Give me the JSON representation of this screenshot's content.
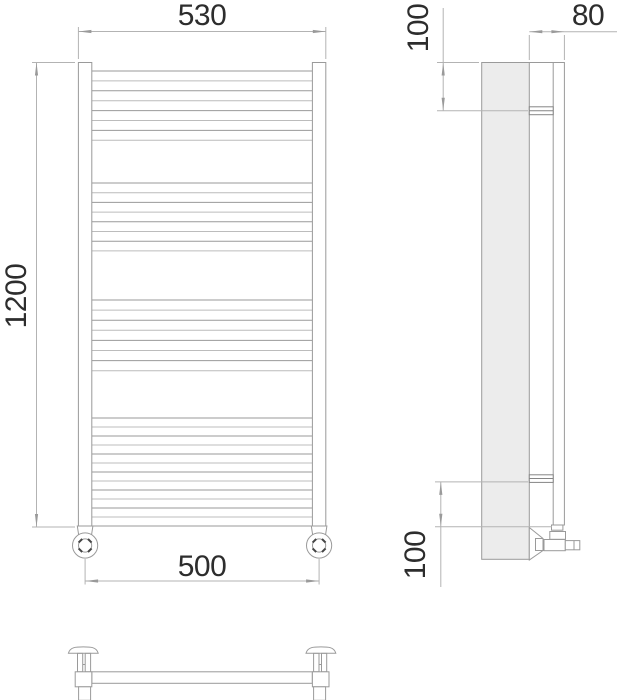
{
  "meta": {
    "type": "technical-drawing",
    "subject": "ladder towel radiator, orthographic projection views"
  },
  "labels": {
    "width_top": "530",
    "height": "1200",
    "width_bottom": "500",
    "depth": "80",
    "offset_top": "100",
    "offset_bottom": "100"
  },
  "colors": {
    "outline": "#9a9a9a",
    "rung_dark": "#9a9a9a",
    "rung_light": "#bcbcbc",
    "dim_line": "#b3b3b3",
    "bracket": "#858585",
    "panel_fill": "#ececec",
    "text": "#2d2d2d",
    "tick_dark": "#444444"
  },
  "front_view": {
    "rung_span_x": [
      92,
      312.4
    ],
    "rung_groups": [
      {
        "y_start": 71,
        "count": 8,
        "spacing": 9.9
      },
      {
        "y_start": 183,
        "count": 8,
        "spacing": 9.7
      },
      {
        "y_start": 300,
        "count": 8,
        "spacing": 10.1
      },
      {
        "y_start": 418,
        "count": 13,
        "spacing": 9.0
      }
    ]
  }
}
